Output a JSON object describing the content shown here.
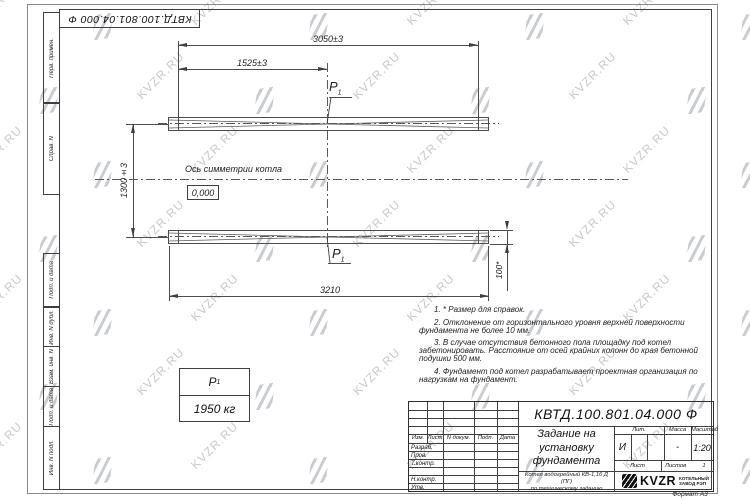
{
  "top_stamp": {
    "designation": "КВТД.100.801.04.000  Ф"
  },
  "frame": {
    "left_labels": [
      "Перв. примен.",
      "Справ. N",
      "Подп. и дата",
      "Инв. N дубл.",
      "Взам. инв. N",
      "Подп. и дата",
      "Инв. N подл."
    ],
    "format_note": "Формат А3"
  },
  "drawing": {
    "dims": {
      "total_top": "3050±3",
      "half_top": "1525±3",
      "between_axes": "1300±3",
      "total_bottom": "3210",
      "profile_height": "100*"
    },
    "axis_label": "Ось симметрии котла",
    "level_mark": "0,000",
    "load_point": {
      "letter": "P",
      "index": "1"
    },
    "load_table": {
      "letter": "P",
      "index": "1",
      "value": "1950 кг"
    }
  },
  "notes": [
    "1. * Размер для справок.",
    "2. Отклонение от горизонтального уровня верхней поверхности фундамента не более 10 мм.",
    "3. В случае отсутствия бетонного пола площадку под котел забетонировать. Расстояние от осей крайних колонн до края бетонной подушки 500 мм.",
    "4. Фундамент под котел разрабатывает проектная организация по нагрузкам на фундамент."
  ],
  "titleblock": {
    "designation": "КВТД.100.801.04.000  Ф",
    "doc_title": "Задание на установку фундамента",
    "product_line1": "Котел водогрейный КВ-1,16 Д (ПГ)",
    "product_line2": "по техническому заданию",
    "cols": {
      "izm": "Изм.",
      "list": "Лист",
      "ndoc": "N докум.",
      "podp": "Подп.",
      "data": "Дата"
    },
    "rows": {
      "r0": "Разраб.",
      "r1": "Пров.",
      "r2": "Т.контр.",
      "r3": "",
      "r4": "Н.контр.",
      "r5": "Утв."
    },
    "lit_label": "Лит.",
    "lit_value": "И",
    "mass_label": "Масса",
    "mass_value": "-",
    "scale_label": "Масштаб",
    "scale_value": "1:20",
    "sheet_label": "Лист",
    "sheets_label": "Листов",
    "sheets_value": "1",
    "logo": {
      "text": "KVZR",
      "caption_line1": "КОТЕЛЬНЫЙ",
      "caption_line2": "ЗАВОД РЭП"
    }
  },
  "watermark": {
    "text": "KVZR.RU",
    "color": "#c6c9cd"
  }
}
